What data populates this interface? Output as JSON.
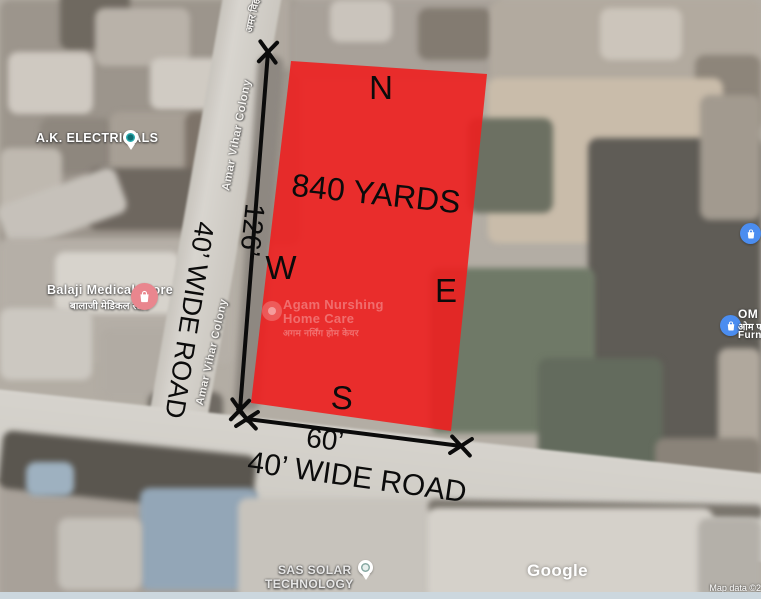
{
  "overlay": {
    "area_label": "840 YARDS",
    "compass_n": "N",
    "compass_e": "E",
    "compass_s": "S",
    "compass_w": "W",
    "west_dimension": "126’",
    "south_dimension": "60’",
    "west_road": "40’ WIDE ROAD",
    "south_road": "40’ WIDE ROAD",
    "plot_color": "#ee1f1f"
  },
  "places": {
    "ak_electricals": "A.K. ELECTRICALS",
    "balaji_name": "Balaji Medical Store",
    "balaji_hindi": "बालाजी मेडिकल स्टोर",
    "agam_line1": "Agam Nurshing",
    "agam_line2": "Home Care",
    "agam_hindi": "अगम नर्सिंग होम केयर",
    "om_line1": "OM",
    "om_hindi": "ओम फर्नि",
    "om_line3": "Furni",
    "sas_line1": "SAS SOLAR",
    "sas_line2": "TECHNOLOGY"
  },
  "streets": {
    "amar_vihar_colony": "Amar Vihar Colony",
    "amar_vihar_hindi": "अमर विहा"
  },
  "footer": {
    "google_logo": "Google",
    "attribution": "Map data ©2"
  }
}
